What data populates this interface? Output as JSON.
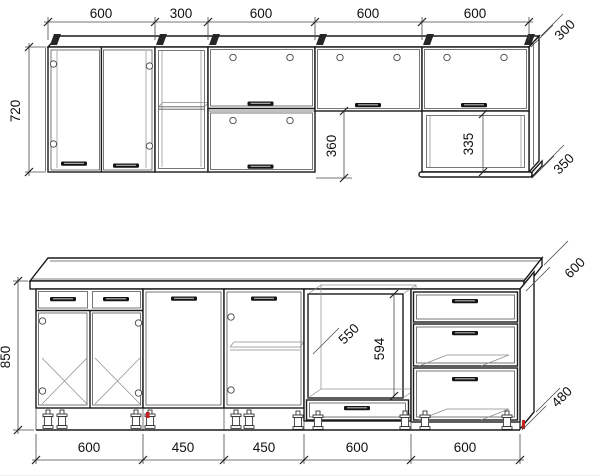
{
  "drawing": {
    "line_color": "#1a1a1a",
    "dimension_color": "#4a4a4a",
    "accent_color": "#c42222",
    "wall_row": {
      "widths": [
        "600",
        "300",
        "600",
        "600",
        "600"
      ],
      "height": "720",
      "depth": "300",
      "hang_gap": "360",
      "open_shelf_height": "335",
      "open_shelf_depth": "350"
    },
    "base_row": {
      "widths": [
        "600",
        "450",
        "450",
        "600",
        "600"
      ],
      "height": "850",
      "worktop_depth": "600",
      "oven_niche_width": "550",
      "oven_niche_height": "594",
      "carcass_depth": "480"
    }
  }
}
